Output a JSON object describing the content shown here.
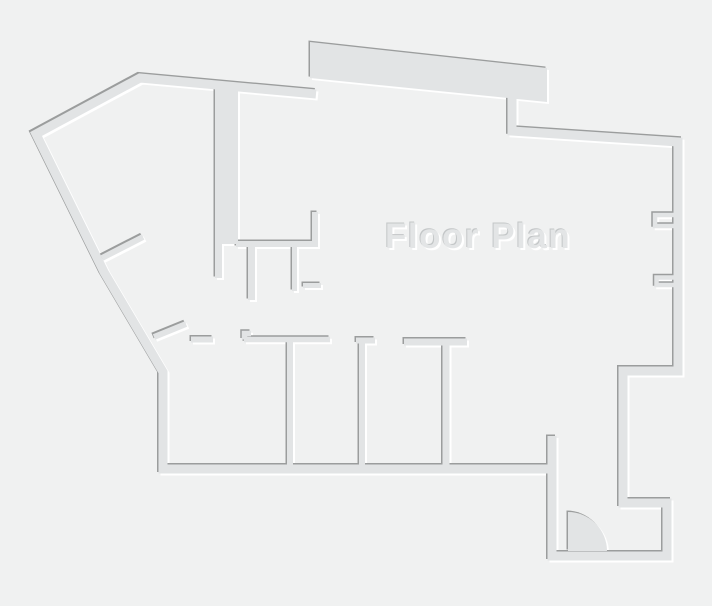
{
  "canvas": {
    "width": 712,
    "height": 606
  },
  "title": {
    "text": "Floor Plan"
  },
  "colors": {
    "background": "#f0f1f1",
    "wall": "#e2e4e5",
    "shadow_dark": "#9b9d9d",
    "shadow_light": "#ffffff",
    "label_fill": "#e3e5e6",
    "label_shadow_dark": "#c3c6c7",
    "label_shadow_light": "#ffffff"
  },
  "floorplan": {
    "label": {
      "x": 385,
      "y": 248,
      "font_size": 35,
      "letter_spacing": 1.5
    },
    "walls": [
      {
        "name": "outer-wall-left",
        "d": "M 316,94 L 140,78 L 36,134 L 104,272 L 163,372 L 163,469 L 552,469",
        "w": 9
      },
      {
        "name": "outer-wall-right",
        "d": "M 512,98 L 512,131 L 678,142 L 678,371 L 623,371 L 623,503 L 667,503 L 667,556 L 552,556 L 552,436",
        "w": 9
      },
      {
        "name": "core-column-wall",
        "d": "M 226.5,84 L 226.5,244",
        "w": 23
      },
      {
        "name": "core-lower-wall",
        "d": "M 218.5,242 L 218.5,278",
        "w": 7
      },
      {
        "name": "core-shelf-wall",
        "d": "M 236,244 L 318,244",
        "w": 6
      },
      {
        "name": "core-stub-up",
        "d": "M 315,245 L 315,212",
        "w": 6
      },
      {
        "name": "core-stub-down-1",
        "d": "M 251.5,246 L 251.5,300",
        "w": 7
      },
      {
        "name": "core-stub-down-2",
        "d": "M 294.5,246 L 294.5,291",
        "w": 5
      },
      {
        "name": "core-ledge",
        "d": "M 303,285.5 L 321,285.5",
        "w": 5
      },
      {
        "name": "door-lintel",
        "d": "M 191,339.5 L 213,339.5",
        "w": 6
      },
      {
        "name": "room1-top-wall",
        "d": "M 251,333.5 L 244.5,333.5 L 244.5,339.5 M 244,339.5 L 330,339.5",
        "w": 5.5
      },
      {
        "name": "room-divider-1",
        "d": "M 290,340 L 290,467",
        "w": 6
      },
      {
        "name": "room-divider-2",
        "d": "M 356,340.5 L 375,340.5 M 362,342 L 362,467",
        "w": 6
      },
      {
        "name": "room-divider-3",
        "d": "M 404,342 L 467,342 M 446,344 L 446,467",
        "w": 7
      },
      {
        "name": "wall-niche-upper",
        "d": "M 678,215 L 655,215 L 655,226 L 678,226",
        "w": 4.5
      },
      {
        "name": "wall-niche-lower",
        "d": "M 678,277.5 L 656.5,277.5 L 656.5,285 L 678,285",
        "w": 4.5
      },
      {
        "name": "door-leaf-upper",
        "d": "M 102,258 L 143,237",
        "w": 6
      },
      {
        "name": "door-leaf-lower",
        "d": "M 154,337 L 186,324",
        "w": 6
      }
    ],
    "fills": [
      {
        "name": "top-terrace-slab",
        "d": "M 310,42 L 547,68 L 547,102 L 310,78 Z"
      },
      {
        "name": "door-swing-arc",
        "d": "M 568,551 L 568,512 A 39 39 0 0 1 607,551 Z"
      }
    ]
  }
}
